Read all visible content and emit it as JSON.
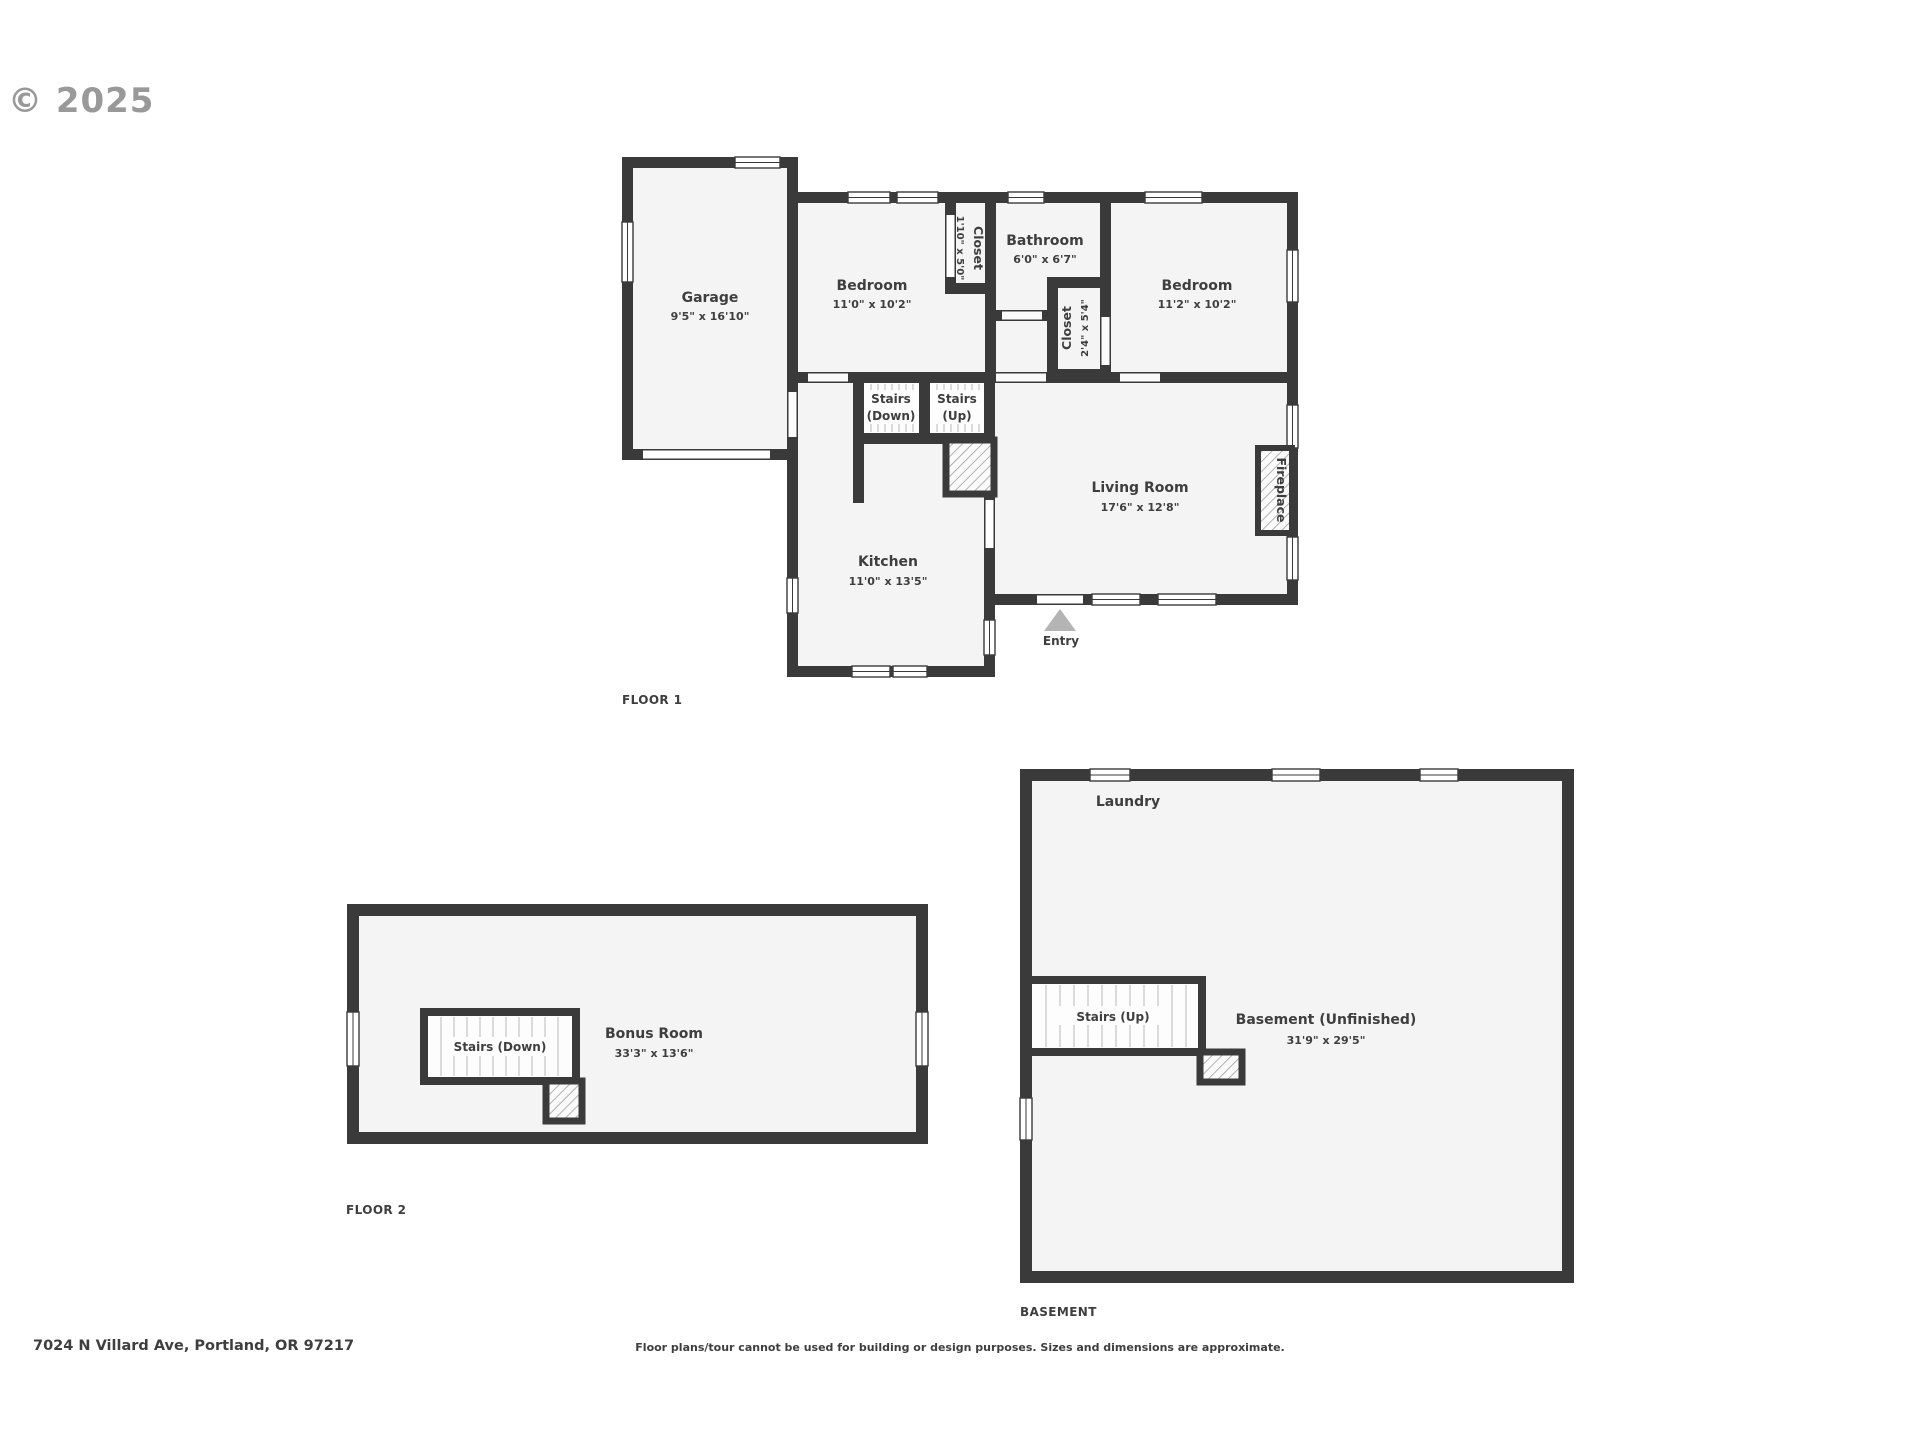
{
  "watermark": "© 2025",
  "floor1": {
    "label": "FLOOR 1",
    "garage": {
      "name": "Garage",
      "dims": "9'5\" x 16'10\""
    },
    "bedroom1": {
      "name": "Bedroom",
      "dims": "11'0\" x 10'2\""
    },
    "closet1": {
      "name": "Closet",
      "dims": "1'10\" x 5'0\""
    },
    "bathroom": {
      "name": "Bathroom",
      "dims": "6'0\" x 6'7\""
    },
    "closet2": {
      "name": "Closet",
      "dims": "2'4\" x 5'4\""
    },
    "bedroom2": {
      "name": "Bedroom",
      "dims": "11'2\" x 10'2\""
    },
    "stairs_down": {
      "line1": "Stairs",
      "line2": "(Down)"
    },
    "stairs_up": {
      "line1": "Stairs",
      "line2": "(Up)"
    },
    "living_room": {
      "name": "Living Room",
      "dims": "17'6\" x 12'8\""
    },
    "fireplace": {
      "name": "Fireplace"
    },
    "kitchen": {
      "name": "Kitchen",
      "dims": "11'0\" x 13'5\""
    },
    "entry": {
      "name": "Entry"
    }
  },
  "floor2": {
    "label": "FLOOR 2",
    "stairs": {
      "name": "Stairs (Down)"
    },
    "bonus_room": {
      "name": "Bonus Room",
      "dims": "33'3\" x 13'6\""
    }
  },
  "basement": {
    "label": "BASEMENT",
    "laundry": {
      "name": "Laundry"
    },
    "stairs": {
      "name": "Stairs (Up)"
    },
    "unfinished": {
      "name": "Basement (Unfinished)",
      "dims": "31'9\" x 29'5\""
    }
  },
  "footer": {
    "address": "7024 N Villard Ave, Portland, OR 97217",
    "disclaimer": "Floor plans/tour cannot be used for building or design purposes. Sizes and dimensions are approximate."
  },
  "colors": {
    "wall": "#3a3a3a",
    "room_fill": "#f4f4f4",
    "text": "#3e3e3e",
    "watermark": "#8e8e8e",
    "entry_arrow": "#b4b4b4"
  }
}
